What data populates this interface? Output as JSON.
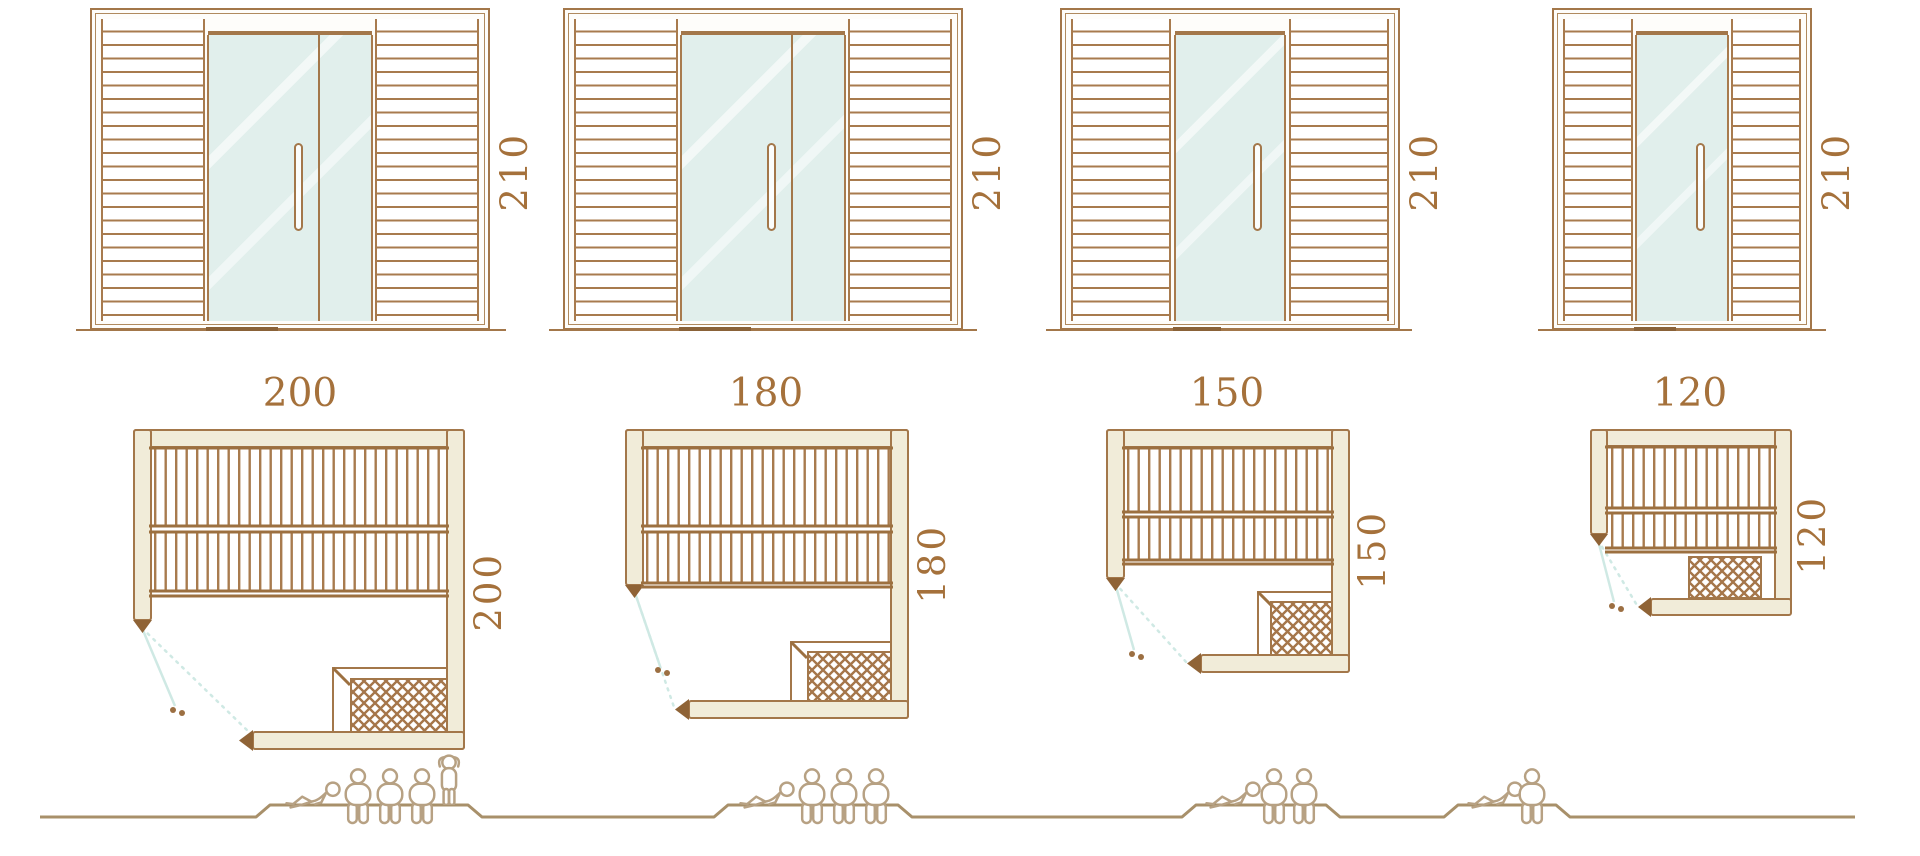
{
  "diagram_title": "Sauna cabin size comparison",
  "palette": {
    "outline_brown": "#a3774a",
    "slat_brown": "#a87b4e",
    "label_brown": "#a5713b",
    "wall_cream": "#f1ecd9",
    "glass_teal": "#e1efec",
    "door_swing_teal": "#cfe9e4",
    "lattice_brown": "#a5764a",
    "people_tan": "#b7a183",
    "ground_tan": "#a8906a"
  },
  "models": [
    {
      "id": "sauna-200",
      "front": {
        "height_label": "210",
        "door_type": "double"
      },
      "plan": {
        "width_label": "200",
        "depth_label": "200"
      },
      "capacity": {
        "lying": 1,
        "seated": 3,
        "standing": 1,
        "total": 5
      }
    },
    {
      "id": "sauna-180",
      "front": {
        "height_label": "210",
        "door_type": "double"
      },
      "plan": {
        "width_label": "180",
        "depth_label": "180"
      },
      "capacity": {
        "lying": 1,
        "seated": 3,
        "standing": 0,
        "total": 4
      }
    },
    {
      "id": "sauna-150",
      "front": {
        "height_label": "210",
        "door_type": "single"
      },
      "plan": {
        "width_label": "150",
        "depth_label": "150"
      },
      "capacity": {
        "lying": 1,
        "seated": 2,
        "standing": 0,
        "total": 3
      }
    },
    {
      "id": "sauna-120",
      "front": {
        "height_label": "210",
        "door_type": "single"
      },
      "plan": {
        "width_label": "120",
        "depth_label": "120"
      },
      "capacity": {
        "lying": 1,
        "seated": 1,
        "standing": 0,
        "total": 2
      }
    }
  ]
}
